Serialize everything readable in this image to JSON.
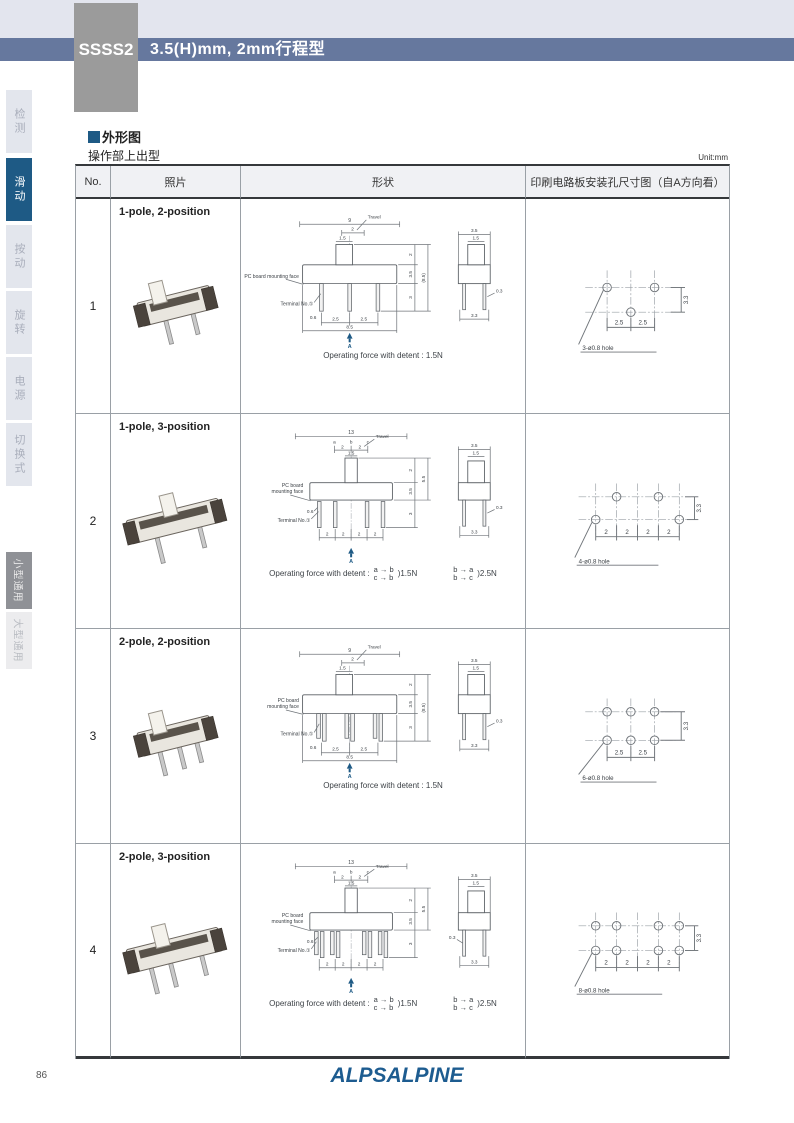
{
  "header": {
    "model": "SSSS2",
    "title": "3.5(H)mm, 2mm行程型"
  },
  "sidebar": {
    "top_items": [
      {
        "label": "检测",
        "active": false
      },
      {
        "label": "滑动",
        "active": true
      },
      {
        "label": "按动",
        "active": false
      },
      {
        "label": "旋转",
        "active": false
      },
      {
        "label": "电源",
        "active": false
      },
      {
        "label": "切换式",
        "active": false
      }
    ],
    "bottom_items": [
      {
        "label": "小型通用",
        "active": true
      },
      {
        "label": "大型通用",
        "active": false
      }
    ]
  },
  "section": {
    "heading": "外形图",
    "subheading": "操作部上出型",
    "unit": "Unit:mm"
  },
  "table": {
    "columns": [
      "No.",
      "照片",
      "形状",
      "印刷电路板安装孔尺寸图（自A方向看）"
    ]
  },
  "labels": {
    "travel": "Travel",
    "terminal": "Terminal No.①",
    "a_marker": "A"
  },
  "rows": [
    {
      "no": "1",
      "type_label": "1-pole, 2-position",
      "pcb": [
        "PC board mounting face"
      ],
      "front": {
        "w": "9",
        "travel": "2",
        "knob": "1.5",
        "hk": "2",
        "hb": "3.5",
        "ho": "(8.5)",
        "ht": "3",
        "tw": "0.6",
        "p1": "2.5",
        "p2": "2.5",
        "base": "8.5"
      },
      "side": {
        "w": "3.5",
        "knob": "1.5",
        "t": "0.3",
        "base": "3.3"
      },
      "op": "Operating force with detent : 1.5N",
      "holes": {
        "h1": "2.5",
        "h2": "2.5",
        "v": "3.3",
        "label": "3-ø0.8 hole"
      }
    },
    {
      "no": "2",
      "type_label": "1-pole, 3-position",
      "pcb": [
        "PC board",
        "mounting face"
      ],
      "front": {
        "w": "13",
        "a": "a",
        "s1": "2",
        "b": "b",
        "s2": "2",
        "c": "c",
        "knob": "1.5",
        "hk": "2",
        "hb": "3.5",
        "ho": "5.5",
        "ht": "3",
        "tw": "0.6",
        "p": [
          "2",
          "2",
          "2",
          "2"
        ]
      },
      "side": {
        "w": "3.5",
        "knob": "1.5",
        "t": "0.3",
        "base": "3.3"
      },
      "op_prefix": "Operating force with detent :",
      "op1": {
        "top": "a → b",
        "bottom": "c → b",
        "force": ")1.5N"
      },
      "op2": {
        "top": "b → a",
        "bottom": "b → c",
        "force": ")2.5N"
      },
      "holes": {
        "p": [
          "2",
          "2",
          "2",
          "2"
        ],
        "v": "3.3",
        "label": "4-ø0.8 hole"
      }
    },
    {
      "no": "3",
      "type_label": "2-pole, 2-position",
      "pcb": [
        "PC board",
        "mounting face"
      ],
      "front": {
        "w": "9",
        "travel": "2",
        "knob": "1.5",
        "hk": "2",
        "hb": "3.5",
        "ho": "(8.5)",
        "ht": "3",
        "tw": "0.6",
        "p1": "2.5",
        "p2": "2.5",
        "base": "8.5"
      },
      "side": {
        "w": "3.5",
        "knob": "1.5",
        "t": "0.3",
        "base": "3.3"
      },
      "op": "Operating force with detent : 1.5N",
      "holes": {
        "h1": "2.5",
        "h2": "2.5",
        "v": "3.3",
        "label": "6-ø0.8 hole"
      }
    },
    {
      "no": "4",
      "type_label": "2-pole, 3-position",
      "pcb": [
        "PC board",
        "mounting face"
      ],
      "front": {
        "w": "13",
        "a": "a",
        "s1": "2",
        "b": "b",
        "s2": "2",
        "c": "c",
        "knob": "1.5",
        "hk": "2",
        "hb": "3.5",
        "ho": "5.5",
        "ht": "3",
        "tw": "0.6",
        "p": [
          "2",
          "2",
          "2",
          "2"
        ]
      },
      "side": {
        "w": "3.5",
        "knob": "1.5",
        "t": "0.3",
        "base": "3.3"
      },
      "op_prefix": "Operating force with detent :",
      "op1": {
        "top": "a → b",
        "bottom": "c → b",
        "force": ")1.5N"
      },
      "op2": {
        "top": "b → a",
        "bottom": "b → c",
        "force": ")2.5N"
      },
      "holes": {
        "p": [
          "2",
          "2",
          "2",
          "2"
        ],
        "v": "3.3",
        "label": "8-ø0.8 hole"
      }
    }
  ],
  "footer": {
    "page": "86",
    "logo": "ALPSALPINE"
  }
}
